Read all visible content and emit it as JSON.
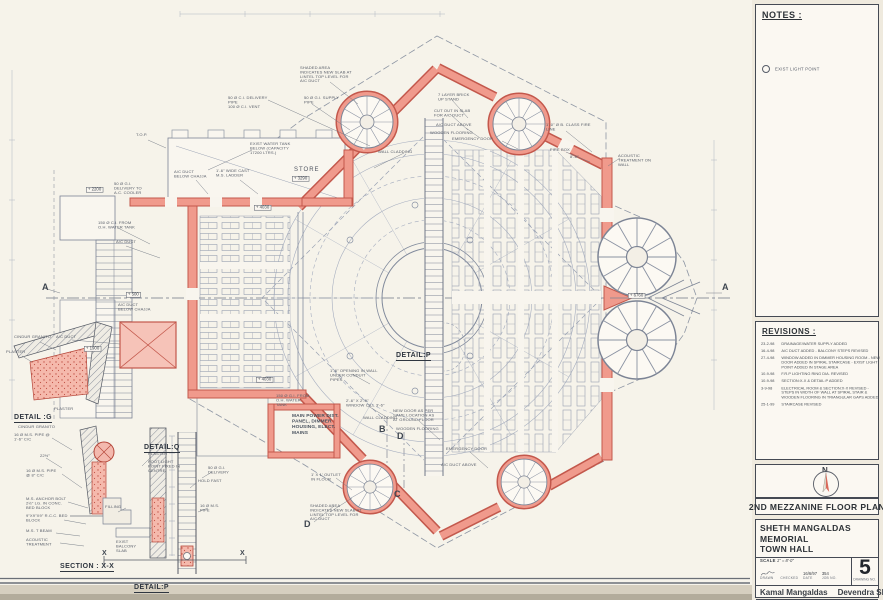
{
  "sheet": {
    "notes": {
      "title": "NOTES :",
      "item_exist_light": "EXIST LIGHT POINT"
    },
    "revisions": {
      "title": "REVISIONS :",
      "entries": [
        {
          "date": "23-2-98",
          "text": "DRAINAGE/WATER SUPPLY ADDED"
        },
        {
          "date": "16-4-98",
          "text": "A/C DUCT ADDED - BALCONY STEPS REVISED"
        },
        {
          "date": "27-4-98",
          "text": "WINDOW ADDED IN DIMMER HOUSING ROOM - NEW DOOR ADDED IN SPIRAL STAIRCASE - EXIST LIGHT POINT ADDED IN STAGE AREA"
        },
        {
          "date": "10-9-98",
          "text": "F.R.P LIGHTING RING DIA. REVISED"
        },
        {
          "date": "10-9-98",
          "text": "SECTION:X-X & DETAIL:P ADDED"
        },
        {
          "date": "3-9-98",
          "text": "ELECTRICAL ROOM & SECTION:X-X REVISED - STEPS IN WIDTH OF WALL AT SPIRAL STAIR & WOODEN FLOORING IN TRIANGULAR GAPS ADDED"
        },
        {
          "date": "25-1-99",
          "text": "STAIRCASE REVISED"
        }
      ]
    },
    "north": "N",
    "drawing_title": "2ND MEZZANINE FLOOR PLAN",
    "project_line1": "SHETH MANGALDAS MEMORIAL",
    "project_line2": "TOWN HALL",
    "scale_label": "SCALE",
    "scale_value": "1\" = 8'-0\"",
    "drawn_label": "DRAWN",
    "checked_label": "CHECKED",
    "date_label": "DATE",
    "date_value": "16/6/97",
    "job_label": "JOB NO.",
    "job_value": "354",
    "dwg_label": "DRAWING NO.",
    "dwg_value": "5",
    "architect1": "Kamal Mangaldas",
    "architect2": "Devendra Shah",
    "address": {
      "a1": "MANGALBAG",
      "a2": "ELLISBRIDGE",
      "a3": "AHMEDABAD",
      "a4": "380 006",
      "a5": "INDIA"
    }
  },
  "plan": {
    "levels": {
      "l2200": "+ 2200",
      "l500": "+ 500",
      "l1900": "+ 1900",
      "l4030a": "+ 4030",
      "l4030b": "+ 4030",
      "l3290": "+ 3290",
      "l6760": "+ 6760"
    },
    "grid": {
      "a_left": "A",
      "a_right": "A",
      "b": "B",
      "c": "C",
      "d1": "D",
      "d2": "D",
      "x_left": "X",
      "x_right": "X"
    },
    "headings": {
      "detail_p_plan": "DETAIL:P",
      "detail_g": "DETAIL :G",
      "detail_q": "DETAIL:Q",
      "section_xx": "SECTION : X-X",
      "detail_p": "DETAIL:P"
    },
    "annotations": {
      "shaded": "SHADED AREA INDICATES NEW SLAB AT LINTEL TOP LEVEL FOR A/C DUCT",
      "delivery_pipe": "50 Ø C.I. DELIVERY PIPE",
      "vent_pipe": "100 Ø C.I. VENT",
      "supply_pipe": "50 Ø G.I. SUPPLY PIPE",
      "water_tank": "EXIST WATER TANK BELOW (CAPACITY 17200 LTRS.)",
      "ladder": "1'-6\" WIDE CAST M.S. LADDER",
      "duct_chajja": "A/C DUCT BELOW CHAJJA",
      "delivery_cooler": "50 Ø G.I. DELIVERY TO A.C. COOLER",
      "topr": "T.O.P.",
      "ohtank": "150 Ø C.I. FROM O.H. WATER TANK",
      "acduct": "A/C DUCT",
      "store": "STORE",
      "brick_upstand": "7 LAYER BRICK UP STAND",
      "cutout_slab": "CUT OUT IN SLAB FOR A/C DUCT",
      "duct_above": "A/C DUCT ABOVE",
      "wooden_flooring": "WOODEN FLOORING",
      "wall_cladding": "WALL CLADDING",
      "emergency_door": "EMERGENCY DOOR",
      "fire_line": "1'-0\" Ø B. CLASS FIRE LINE",
      "fire_box": "FIRE BOX",
      "dim8": "8'-0\"",
      "acoustic_wall": "ACOUSTIC TREATMENT ON WALL",
      "opening_conduit": "1'-6\" OPENING IN WALL UNDER CONDUIT PIPES",
      "main_power": "MAIN POWER DIST. PANEL, DIMMER HOUSING, ELECT. MAINS",
      "window_cill": "2'-6\" X 2'-6\" WINDOW CILL 3'-6\"",
      "new_door": "NEW DOOR AS PER SAME LOCATION AS AT GROUND FLOOR",
      "from_oh_tank": "150 Ø G.I. FROM O.H. WATER TANK",
      "outlet_floor": "1' X 1' OUTLET IN FLOOR",
      "cindur_granito": "CINDUR GRANITO",
      "plaster": "PLASTER",
      "ms_pipe_16": "16 Ø M.S. PIPE @ 1'-6\" C/C",
      "angle": "22½°",
      "ms_pipe_8": "16 Ø M.S. PIPE @ 8\" C/C",
      "anchor": "M.S. ANCHOR BOLT 2½\" LG. IN CONC. BED BLOCK",
      "bed_block": "9\"X9\"X9\" R.C.C. BED BLOCK",
      "t_beam": "M.S. T BEAM",
      "acoustic2": "ACOUSTIC TREATMENT",
      "filling": "FILLING",
      "balcony_slab": "EXIST BALCONY SLAB",
      "hold_fast": "HOLD FAST",
      "ms_pipe_r": "16 Ø M.S. PIPE",
      "foot_light": "FOOT LIGHT POINT FIXED IN CENTRE",
      "delivery_right": "50 Ø G.I. DELIVERY"
    }
  }
}
